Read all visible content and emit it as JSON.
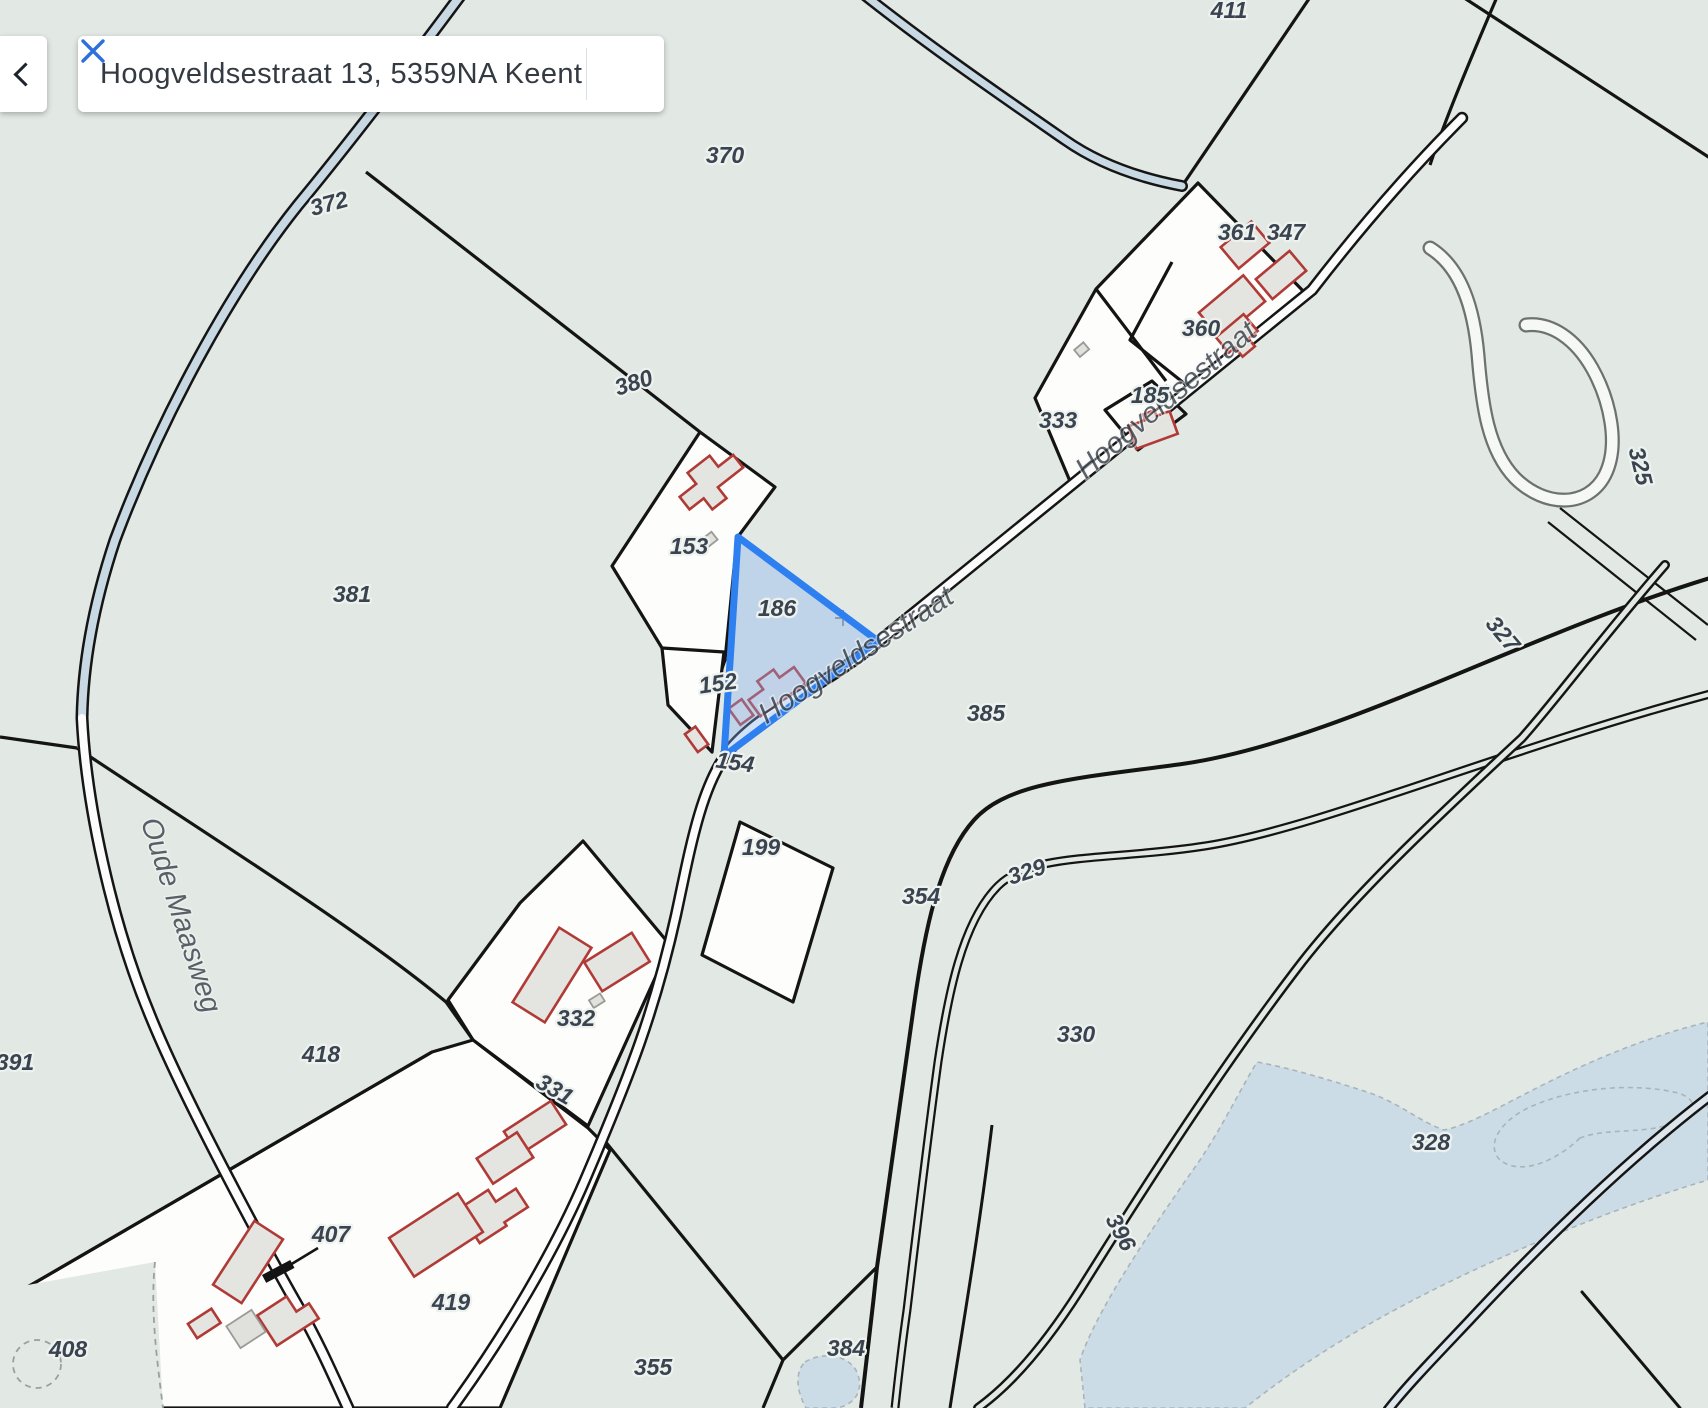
{
  "search_bar": {
    "query": "Hoogveldsestraat 13, 5359NA Keent",
    "back_icon": "chevron-left-icon",
    "clear_icon": "close-icon"
  },
  "theme": {
    "accent_blue": "#2c6fdd",
    "highlight_stroke": "#2e7ff0",
    "highlight_fill": "rgba(130,175,244,0.35)",
    "map_background": "#e2e8e4",
    "water_fill": "#ccdce6",
    "parcel_fill": "#fdfdfc",
    "building_stroke": "#b03a36",
    "building_fill": "#e4e4e0"
  },
  "map": {
    "highlighted_parcel": "186",
    "street_labels": [
      {
        "text": "Hoogveldsestraat",
        "x": 1172,
        "y": 407,
        "rot": -40
      },
      {
        "text": "Hoogveldsestraat",
        "x": 861,
        "y": 663,
        "rot": -33
      },
      {
        "text": "Oude Maasweg",
        "x": 172,
        "y": 918,
        "rot": 72
      }
    ],
    "parcel_labels": [
      {
        "text": "370",
        "x": 725,
        "y": 163,
        "rot": 0
      },
      {
        "text": "372",
        "x": 331,
        "y": 211,
        "rot": -15
      },
      {
        "text": "411",
        "x": 1229,
        "y": 18,
        "rot": 0
      },
      {
        "text": "347",
        "x": 1286,
        "y": 240,
        "rot": 0
      },
      {
        "text": "361",
        "x": 1237,
        "y": 240,
        "rot": 0
      },
      {
        "text": "360",
        "x": 1201,
        "y": 336,
        "rot": 0
      },
      {
        "text": "333",
        "x": 1058,
        "y": 428,
        "rot": 0
      },
      {
        "text": "185",
        "x": 1150,
        "y": 403,
        "rot": 0
      },
      {
        "text": "380",
        "x": 636,
        "y": 390,
        "rot": -18
      },
      {
        "text": "153",
        "x": 689,
        "y": 554,
        "rot": 0
      },
      {
        "text": "186",
        "x": 777,
        "y": 616,
        "rot": 0
      },
      {
        "text": "152",
        "x": 719,
        "y": 691,
        "rot": -8
      },
      {
        "text": "154",
        "x": 734,
        "y": 770,
        "rot": 8
      },
      {
        "text": "381",
        "x": 352,
        "y": 602,
        "rot": 0
      },
      {
        "text": "385",
        "x": 986,
        "y": 721,
        "rot": 0
      },
      {
        "text": "199",
        "x": 761,
        "y": 855,
        "rot": 0
      },
      {
        "text": "354",
        "x": 921,
        "y": 904,
        "rot": 0
      },
      {
        "text": "329",
        "x": 1029,
        "y": 879,
        "rot": -18
      },
      {
        "text": "330",
        "x": 1076,
        "y": 1042,
        "rot": 0
      },
      {
        "text": "328",
        "x": 1431,
        "y": 1150,
        "rot": 0
      },
      {
        "text": "325",
        "x": 1633,
        "y": 468,
        "rot": 76
      },
      {
        "text": "327",
        "x": 1497,
        "y": 639,
        "rot": 50
      },
      {
        "text": "332",
        "x": 576,
        "y": 1026,
        "rot": 0
      },
      {
        "text": "331",
        "x": 551,
        "y": 1096,
        "rot": 30
      },
      {
        "text": "418",
        "x": 321,
        "y": 1062,
        "rot": 0
      },
      {
        "text": "391",
        "x": 15,
        "y": 1070,
        "rot": 0
      },
      {
        "text": "407",
        "x": 331,
        "y": 1242,
        "rot": 0
      },
      {
        "text": "408",
        "x": 68,
        "y": 1357,
        "rot": 0
      },
      {
        "text": "419",
        "x": 451,
        "y": 1310,
        "rot": 0
      },
      {
        "text": "355",
        "x": 653,
        "y": 1375,
        "rot": 0
      },
      {
        "text": "384",
        "x": 846,
        "y": 1356,
        "rot": 0
      },
      {
        "text": "396",
        "x": 1114,
        "y": 1236,
        "rot": 62
      }
    ]
  }
}
